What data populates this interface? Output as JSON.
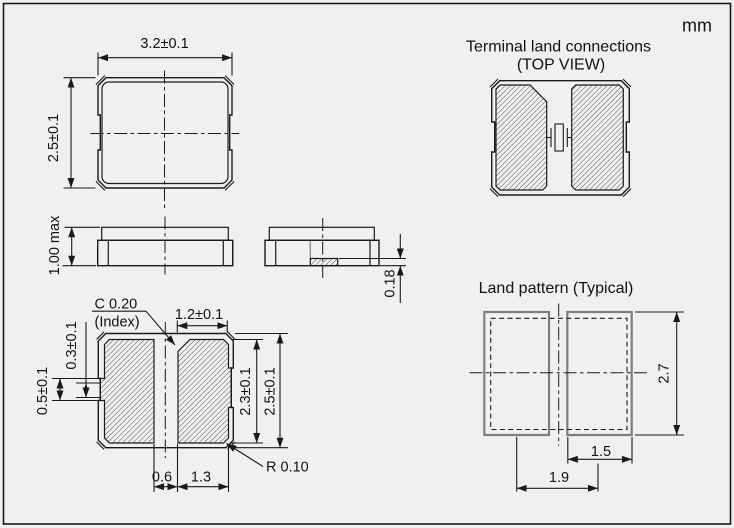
{
  "unit": "mm",
  "top_view": {
    "dim_width": "3.2±0.1",
    "dim_height": "2.5±0.1"
  },
  "side_view": {
    "dim_height": "1.00 max",
    "dim_electrode": "0.18"
  },
  "bottom_view": {
    "index_chamfer": "C 0.20",
    "index_chamfer_note": "(Index)",
    "dim_pad_width": "1.2±0.1",
    "dim_side_notch_inner": "0.3±0.1",
    "dim_side_notch_outer": "0.5±0.1",
    "dim_pad_length": "2.3±0.1",
    "dim_body_width": "2.5±0.1",
    "dim_pad_gap": "0.6",
    "dim_pad_to_edge": "1.3",
    "corner_radius": "R 0.10"
  },
  "terminal_view": {
    "title": "Terminal land connections",
    "subtitle": "(TOP VIEW)"
  },
  "land_pattern": {
    "title": "Land pattern (Typical)",
    "dim_pad_height": "2.7",
    "dim_pad_width": "1.5",
    "dim_pad_pitch": "1.9"
  },
  "colors": {
    "background": "#f0f0f0",
    "line": "#1a1a1a",
    "land_pad_stroke": "#7f7f7f",
    "hatch": "#2a2a2a"
  }
}
